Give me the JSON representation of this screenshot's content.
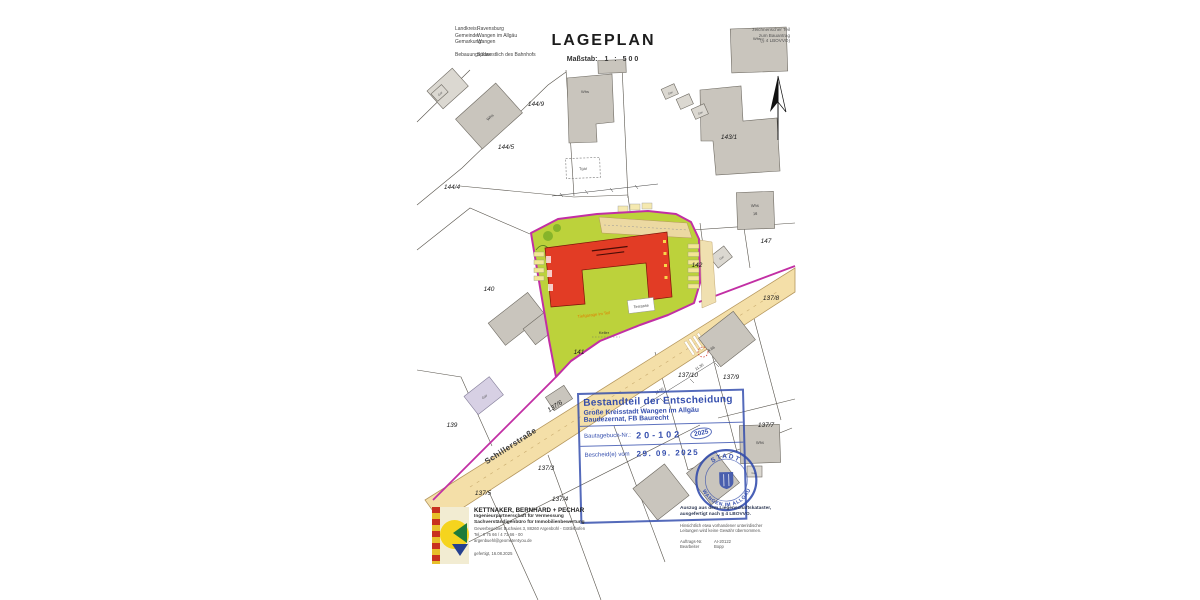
{
  "header": {
    "landkreis_label": "Landkreis:",
    "landkreis": "Ravensburg",
    "gemeinde_label": "Gemeinde:",
    "gemeinde": "Wangen im Allgäu",
    "gemarkung_label": "Gemarkung:",
    "gemarkung": "Wangen",
    "bebauungsplan_label": "Bebauungsplan:",
    "bebauungsplan": "Südwestlich des Bahnhofs",
    "title": "LAGEPLAN",
    "scale_label": "Maßstab:",
    "scale_value": "1 : 500",
    "right": [
      "zeichnerischer Teil",
      "zum Bauantrag",
      "(§ 4 LBOVVO)"
    ]
  },
  "map": {
    "street": "Schillerstraße",
    "parcels": [
      "144/9",
      "144/5",
      "144/4",
      "143/1",
      "147",
      "142",
      "140",
      "139",
      "141",
      "137/8",
      "137/10",
      "137/9",
      "137/7",
      "137/6",
      "137/3",
      "137/5",
      "137/4"
    ],
    "buildings": {
      "whs": "Whs",
      "gar": "Gar",
      "tgar": "Tgar",
      "whs16": "16"
    },
    "site": {
      "terrasse": "Terrasse",
      "tiefgarage": "Tiefgarage im Teil",
      "keller": "Keller"
    },
    "dims": {
      "d1": "16.50",
      "d2": "11.30",
      "d3": "4.66"
    }
  },
  "stamp": {
    "line1": "Bestandteil der Entscheidung",
    "line2": "Große Kreisstadt Wangen im Allgäu",
    "line3": "Baudezernat, FB Baurecht",
    "no_label": "Bautagebuch-Nr.:",
    "no_value": "20-102",
    "no_year": "2025",
    "date_label": "Bescheid(e) vom",
    "date_value": "29. 09. 2025",
    "seal_top": "STADT",
    "seal_bottom": "WANGEN IM ALLGÄU"
  },
  "footer": {
    "company": {
      "name": "KETTNAKER, BERNHARD + PECHAR",
      "line1": "Ingenieurpartnerschaft für Vermessung",
      "line2": "Sachverständigenbüro für Immobilienbewertung",
      "address": "Gewerbegebiet Buchwies 3, 88260 Argenbühl - Göttlishofen",
      "phone": "Tel.: 0 75 66 / 4 73 66 - 00",
      "email": "argenbuehl@geometer4you.de",
      "created": "gefertigt, 16.08.2025"
    },
    "notes": {
      "bold1": "Auszug aus dem Liegenschaftskataster,",
      "bold2": "ausgefertigt nach § 4 LBOVVO.",
      "note1": "Hinsichtlich etwa vorhandener unterirdischer",
      "note2": "Leitungen wird keine Gewähr übernommen.",
      "order_label": "Auftrags-Nr.",
      "order_value": "AI-20122",
      "editor_label": "Bearbeiter",
      "editor_value": "Bopp"
    }
  }
}
